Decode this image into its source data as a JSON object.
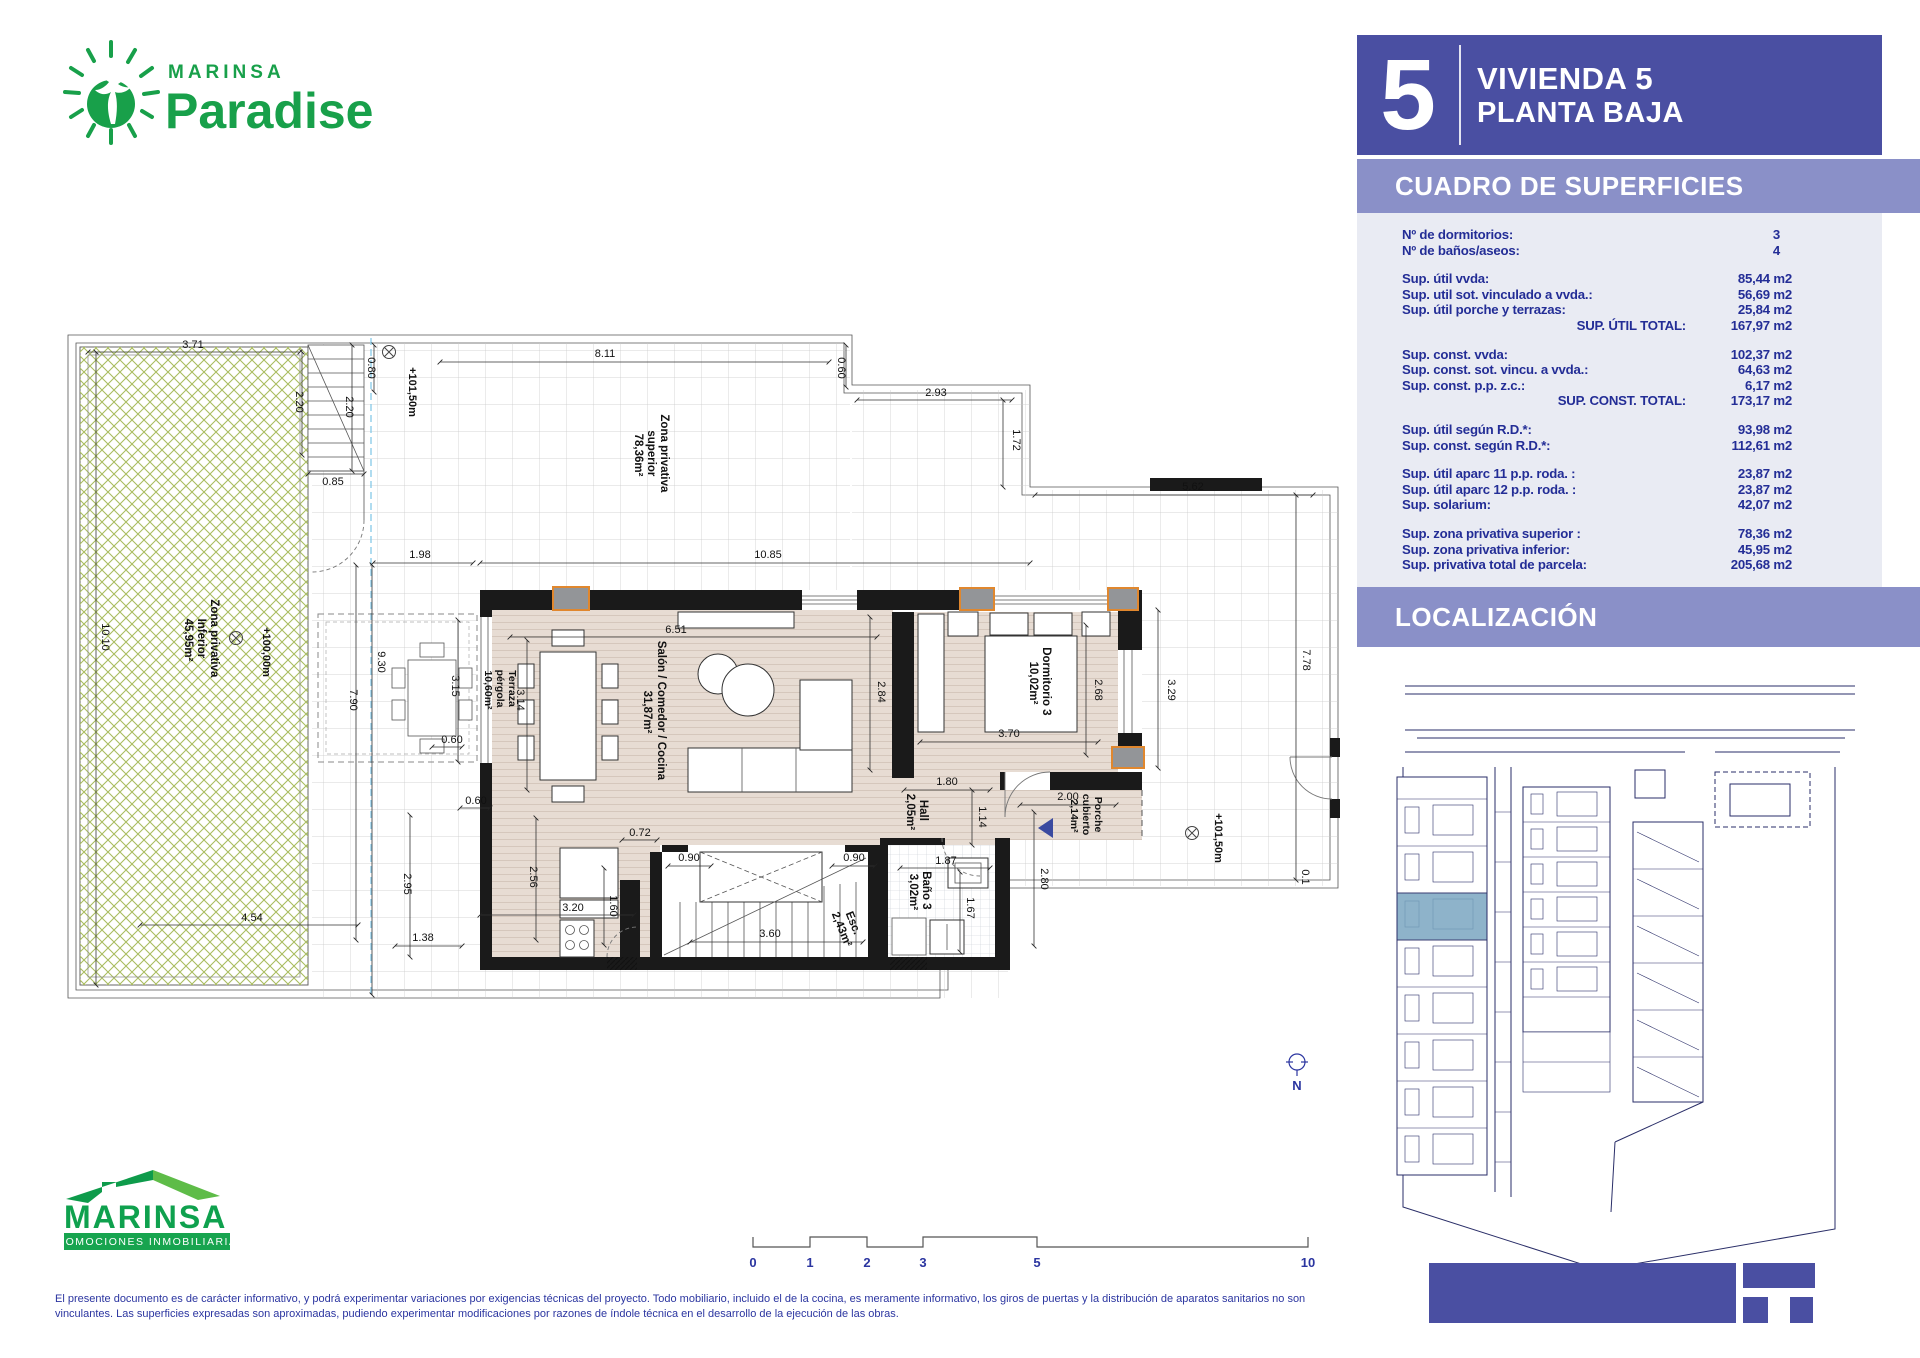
{
  "header_logo": {
    "brand": "MARINSA",
    "product": "Paradise"
  },
  "sidebar": {
    "unit_number": "5",
    "title_line1": "VIVIENDA 5",
    "title_line2": "PLANTA BAJA",
    "surfaces_title": "CUADRO DE SUPERFICIES",
    "location_title": "LOCALIZACIÓN",
    "counts": {
      "dorm_label": "Nº de dormitorios:",
      "dorm_value": "3",
      "bath_label": "Nº de baños/aseos:",
      "bath_value": "4"
    },
    "util": {
      "r1l": "Sup. útil vvda:",
      "r1v": "85,44 m2",
      "r2l": "Sup. util sot. vinculado a vvda.:",
      "r2v": "56,69 m2",
      "r3l": "Sup. útil porche y terrazas:",
      "r3v": "25,84 m2",
      "totl": "SUP. ÚTIL TOTAL:",
      "totv": "167,97 m2"
    },
    "const": {
      "r1l": "Sup. const. vvda:",
      "r1v": "102,37 m2",
      "r2l": "Sup. const. sot. vincu. a vvda.:",
      "r2v": "64,63 m2",
      "r3l": "Sup. const. p.p. z.c.:",
      "r3v": "6,17 m2",
      "totl": "SUP. CONST. TOTAL:",
      "totv": "173,17 m2"
    },
    "rd": {
      "r1l": "Sup. útil según R.D.*:",
      "r1v": "93,98 m2",
      "r2l": "Sup. const. según R.D.*:",
      "r2v": "112,61 m2"
    },
    "aparc": {
      "r1l": "Sup. útil aparc 11 p.p. roda. :",
      "r1v": "23,87 m2",
      "r2l": "Sup. útil aparc 12 p.p. roda. :",
      "r2v": "23,87 m2",
      "r3l": "Sup. solarium:",
      "r3v": "42,07 m2"
    },
    "priv": {
      "r1l": "Sup. zona privativa superior :",
      "r1v": "78,36 m2",
      "r2l": "Sup. zona privativa inferior:",
      "r2v": "45,95 m2",
      "r3l": "Sup. privativa total de parcela:",
      "r3v": "205,68 m2"
    }
  },
  "plan": {
    "rooms": {
      "zpi1": "Zona privativa",
      "zpi2": "Inferior",
      "zpi3": "45,95m²",
      "zps1": "Zona privativa",
      "zps2": "superior",
      "zps3": "78,36m²",
      "ter1": "Terraza",
      "ter2": "pérgola",
      "ter3": "10,60m²",
      "sal1": "Salón / Comedor / Cocina",
      "sal2": "31,87m²",
      "dor1": "Dormitorio 3",
      "dor2": "10,02m²",
      "hall1": "Hall",
      "hall2": "2,05m²",
      "ban1": "Baño 3",
      "ban2": "3,02m²",
      "esc1": "Esc.",
      "esc2": "2,43m²",
      "por1": "Porche",
      "por2": "cubierto",
      "por3": "2,14m²"
    },
    "levels": {
      "l1": "+101,50m",
      "l2": "+100,00m",
      "l3": "+101,50m"
    },
    "dims": {
      "d1": "3.71",
      "d2": "2.20",
      "d3": "0.80",
      "d4": "2.20",
      "d5": "0.85",
      "d6": "8.11",
      "d7": "0.60",
      "d8": "2.93",
      "d9": "1.72",
      "d10": "5.62",
      "d11": "1.98",
      "d12": "10.85",
      "d13": "6.51",
      "d14": "3.15",
      "d15": "0.60",
      "d16": "3.14",
      "d17": "2.84",
      "d18": "2.68",
      "d19": "3.29",
      "d20": "3.70",
      "d21": "1.80",
      "d22": "1.14",
      "d23": "2.00",
      "d24": "2.80",
      "d25": "1.87",
      "d26": "1.67",
      "d27": "0.90",
      "d28": "0.90",
      "d29": "3.60",
      "d30": "1.60",
      "d31": "0.72",
      "d32": "10.10",
      "d33": "9.30",
      "d34": "7.90",
      "d35": "2.95",
      "d36": "1.38",
      "d37": "4.54",
      "d38": "2.56",
      "d39": "3.20",
      "d40": "0.60",
      "d41": "7.78",
      "d42": "0.1"
    }
  },
  "scalebar": {
    "t0": "0",
    "t1": "1",
    "t2": "2",
    "t3": "3",
    "t5": "5",
    "t10": "10"
  },
  "north_label": "N",
  "footer_logo": {
    "brand": "MARINSA",
    "tagline": "PROMOCIONES  INMOBILIARIAS"
  },
  "disclaimer": "El presente documento es de carácter informativo, y podrá experimentar variaciones por exigencias técnicas del proyecto. Todo mobiliario, incluido el de la cocina, es meramente informativo, los giros de puertas y la distribución de aparatos sanitarios no son vinculantes. Las superficies expresadas son aproximadas, pudiendo experimentar modificaciones por razones de índole técnica en el desarrollo de la ejecución de las obras."
}
